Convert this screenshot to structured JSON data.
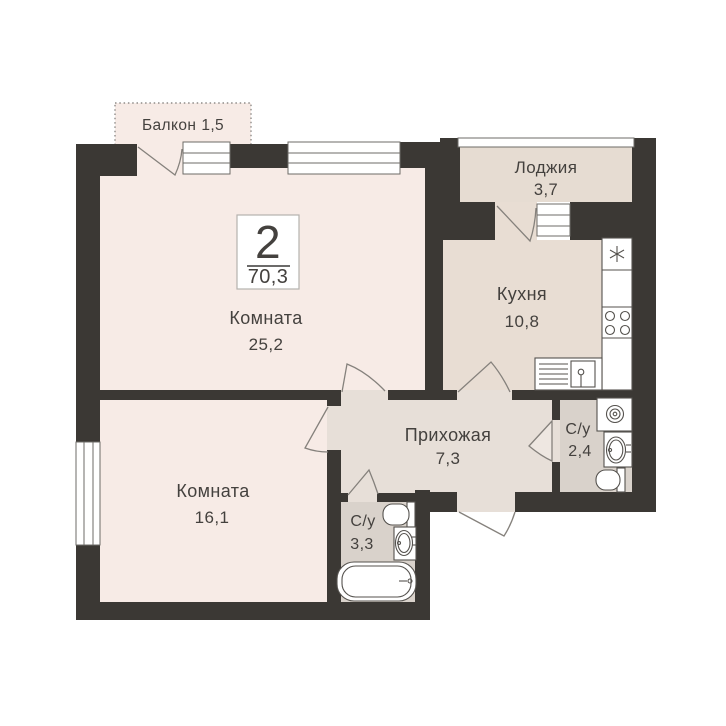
{
  "plan": {
    "title_badge": {
      "rooms_count": "2",
      "total_area": "70,3"
    },
    "rooms": [
      {
        "name": "Балкон",
        "area": "1,5"
      },
      {
        "name": "Лоджия",
        "area": "3,7"
      },
      {
        "name": "Комната",
        "area": "25,2"
      },
      {
        "name": "Кухня",
        "area": "10,8"
      },
      {
        "name": "Прихожая",
        "area": "7,3"
      },
      {
        "name": "С/у",
        "area": "2,4"
      },
      {
        "name": "Комната",
        "area": "16,1"
      },
      {
        "name": "С/у",
        "area": "3,3"
      }
    ],
    "fixtures": {
      "kitchen": [
        "fridge-icon",
        "stove-icon",
        "kitchen-sink-icon"
      ],
      "bathroom_2_4": [
        "washing-machine-icon",
        "sink-icon",
        "toilet-icon"
      ],
      "bathroom_3_3": [
        "toilet-icon",
        "sink-icon",
        "bathtub-icon"
      ]
    }
  },
  "colors": {
    "wall": "#3b3834",
    "room": "#f7ebe6",
    "kitchen": "#e8ddd3",
    "hall": "#e7dfd8",
    "wet": "#d9d2cb",
    "loggia": "#e6dcd2",
    "door": "#85817c",
    "window_stroke": "#6e6b67",
    "fixture_stroke": "#55524e",
    "text": "#44413e",
    "badge_border": "#b5b2ae"
  }
}
